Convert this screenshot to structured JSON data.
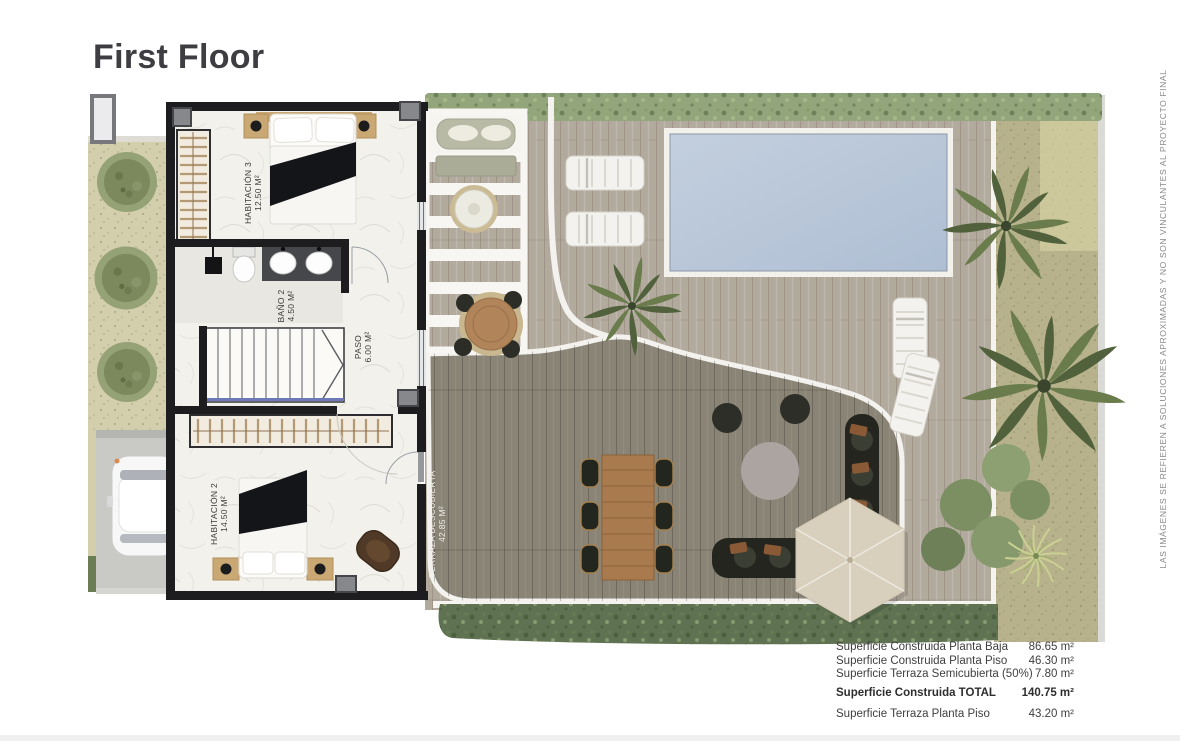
{
  "title": "First Floor",
  "rooms": [
    {
      "name": "HABITACIÓN 3",
      "area": "12.50 m²"
    },
    {
      "name": "BAÑO 2",
      "area": "4.50 m²"
    },
    {
      "name": "PASO",
      "area": "6.00 m²"
    },
    {
      "name": "HABITACIÓN 2",
      "area": "14.50 m²"
    },
    {
      "name": "TERRAZA DESCUBIERTA",
      "area": "42.85 m²"
    }
  ],
  "summary": {
    "rows": [
      {
        "label": "Superficie Construida Planta Baja",
        "value": "86.65 m²"
      },
      {
        "label": "Superficie Construida Planta Piso",
        "value": "46.30 m²"
      },
      {
        "label": "Superficie Terraza Semicubierta (50%)",
        "value": "7.80 m²"
      },
      {
        "label": "Superficie Construida TOTAL",
        "value": "140.75 m²"
      },
      {
        "label": "Superficie Terraza Planta Piso",
        "value": "43.20 m²"
      }
    ]
  },
  "disclaimer": "LAS IMÁGENES SE REFIEREN A SOLUCIONES APROXIMADAS Y NO SON VINCULANTES AL PROYECTO FINAL",
  "colors": {
    "wall": "#1d1d1f",
    "floor": "#f3f1eb",
    "deck": "#b3aa9e",
    "deck_dark": "#8a8477",
    "pool": "#b9c6d8",
    "hedge_top": "#93a57b",
    "hedge_bottom": "#5f7352",
    "garden_left": "#d3cfad",
    "garden_right": "#b7b28b",
    "parasol": "#d8cfbc",
    "stairs_line": "#6d79b8"
  }
}
